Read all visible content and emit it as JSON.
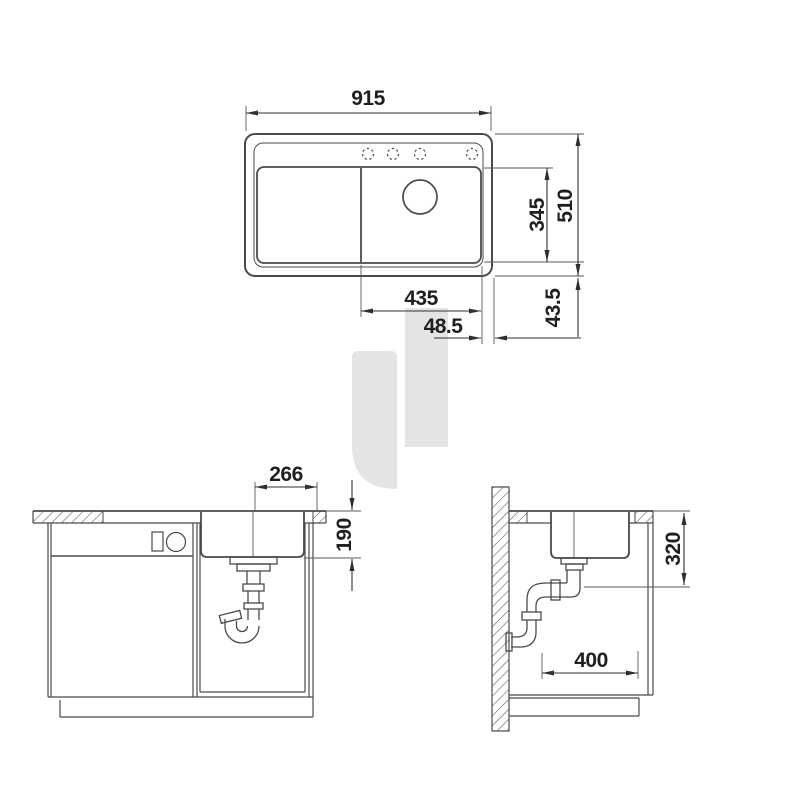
{
  "drawing": {
    "title": "Sink installation technical drawing",
    "colors": {
      "line": "#4a4a4a",
      "dimension": "#2f2f2f",
      "watermark": "#e4e4e4",
      "background": "#ffffff"
    },
    "top_view": {
      "overall_width": "915",
      "overall_depth": "510",
      "bowl_inner_depth": "345",
      "bowl_inner_width": "435",
      "edge_offset_horizontal": "48.5",
      "edge_offset_vertical": "43.5"
    },
    "front_view": {
      "drain_to_edge": "266",
      "bowl_depth": "190"
    },
    "side_view": {
      "under_counter_depth": "320",
      "drain_clearance": "400"
    }
  }
}
